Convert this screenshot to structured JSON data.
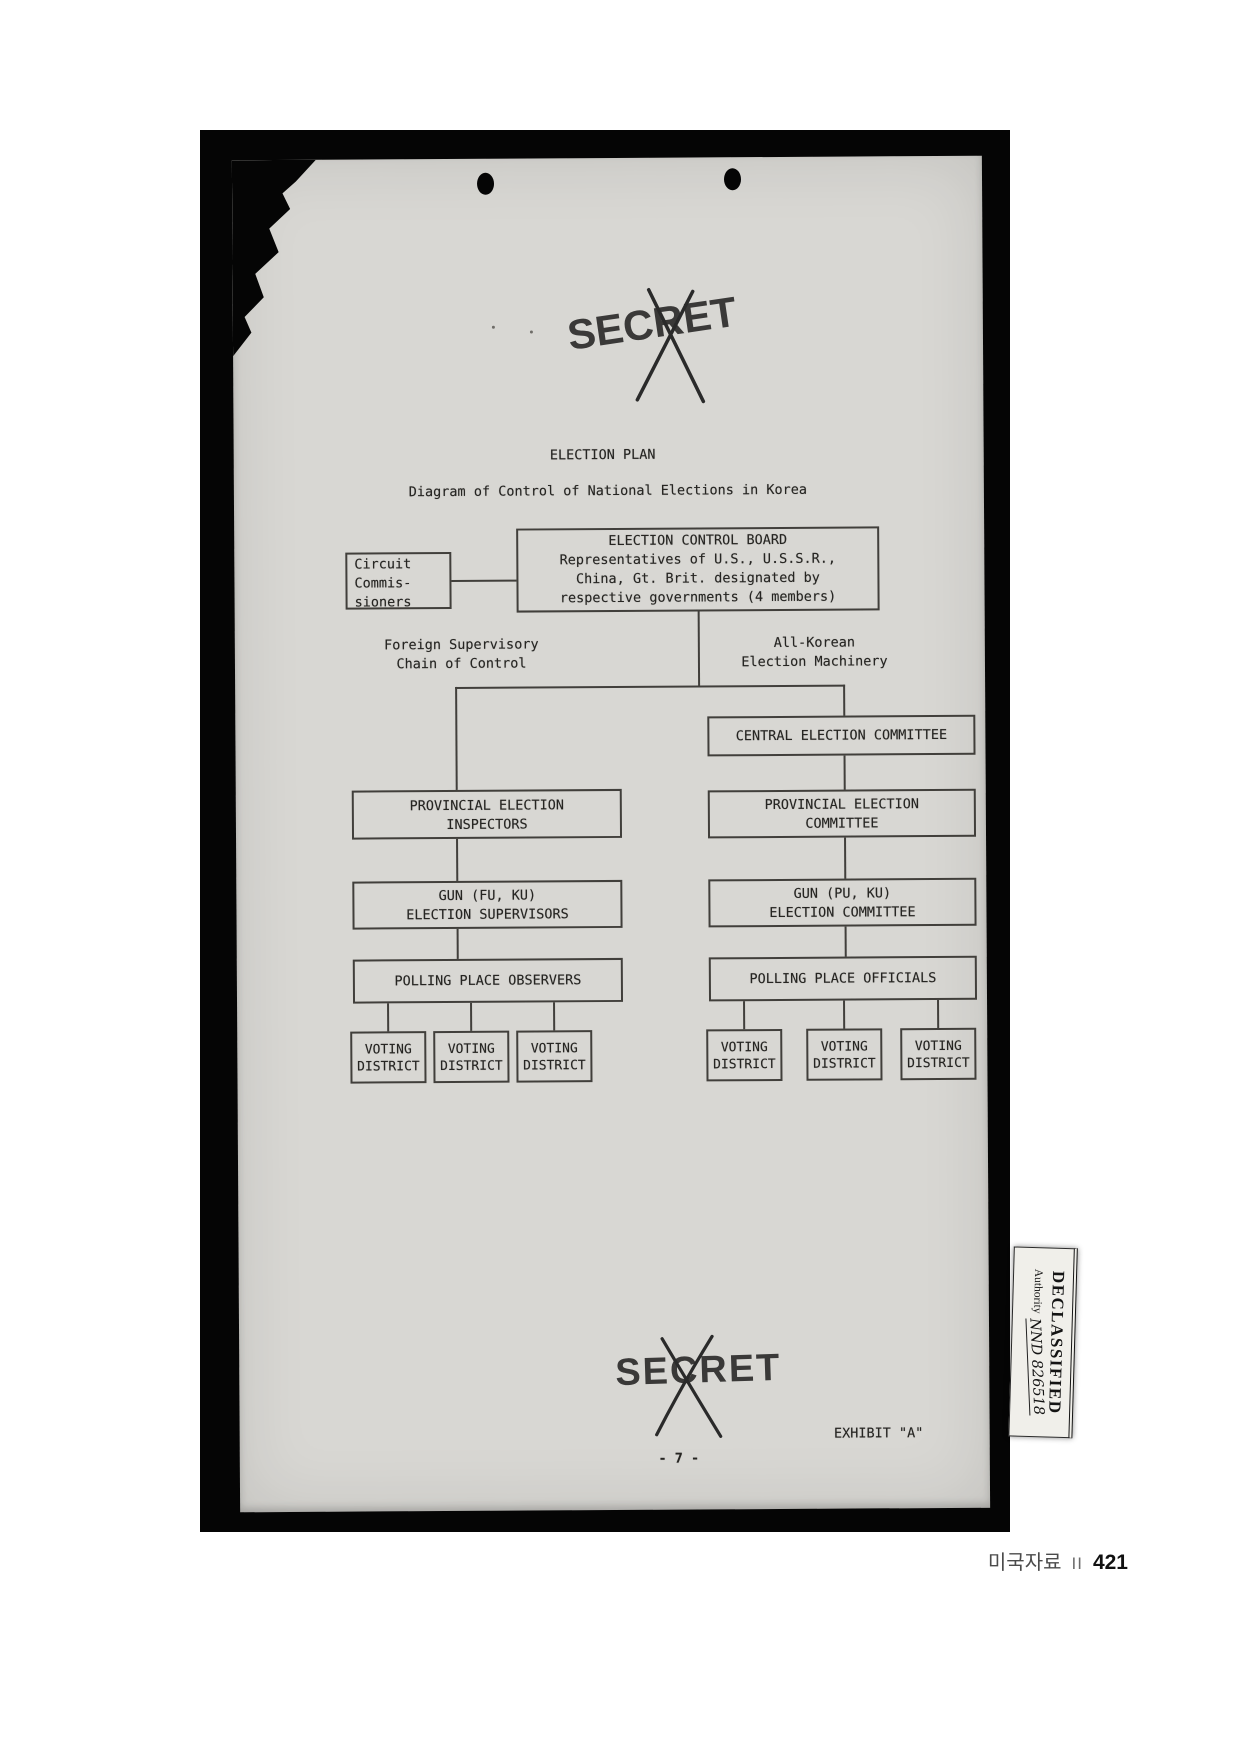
{
  "stamps": {
    "secret": "SECRET"
  },
  "header": {
    "title": "ELECTION PLAN",
    "subtitle": "Diagram of Control of National Elections in Korea"
  },
  "diagram": {
    "circuit_commissioners": {
      "lines": [
        "Circuit",
        "Commis-",
        "sioners"
      ]
    },
    "election_control_board": {
      "lines": [
        "ELECTION CONTROL BOARD",
        "Representatives of U.S., U.S.S.R.,",
        "China, Gt. Brit. designated by",
        "respective governments (4 members)"
      ]
    },
    "branch_labels": {
      "left": {
        "lines": [
          "Foreign Supervisory",
          "Chain of Control"
        ]
      },
      "right": {
        "lines": [
          "All-Korean",
          "Election Machinery"
        ]
      }
    },
    "central_election_committee": "CENTRAL ELECTION COMMITTEE",
    "provincial_election_inspectors": {
      "lines": [
        "PROVINCIAL ELECTION",
        "INSPECTORS"
      ]
    },
    "provincial_election_committee": {
      "lines": [
        "PROVINCIAL ELECTION",
        "COMMITTEE"
      ]
    },
    "gun_election_supervisors": {
      "lines": [
        "GUN (FU, KU)",
        "ELECTION SUPERVISORS"
      ]
    },
    "gun_election_committee": {
      "lines": [
        "GUN (PU, KU)",
        "ELECTION COMMITTEE"
      ]
    },
    "polling_place_observers": "POLLING PLACE OBSERVERS",
    "polling_place_officials": "POLLING PLACE OFFICIALS",
    "voting_district": {
      "lines": [
        "VOTING",
        "DISTRICT"
      ]
    }
  },
  "footer_marks": {
    "exhibit": "EXHIBIT \"A\"",
    "page_number": "- 7 -"
  },
  "declassified": {
    "title": "DECLASSIFIED",
    "authority_label": "Authority",
    "authority_value": "NND 826518"
  },
  "book_footer": {
    "label": "미국자료",
    "volume": "II",
    "page": "421"
  },
  "colors": {
    "paper": "#d8d7d3",
    "ink": "#262522",
    "line": "#413f3b",
    "scan_bed": "#050505",
    "footer_text": "#4b4b4b",
    "footer_page": "#111111"
  }
}
